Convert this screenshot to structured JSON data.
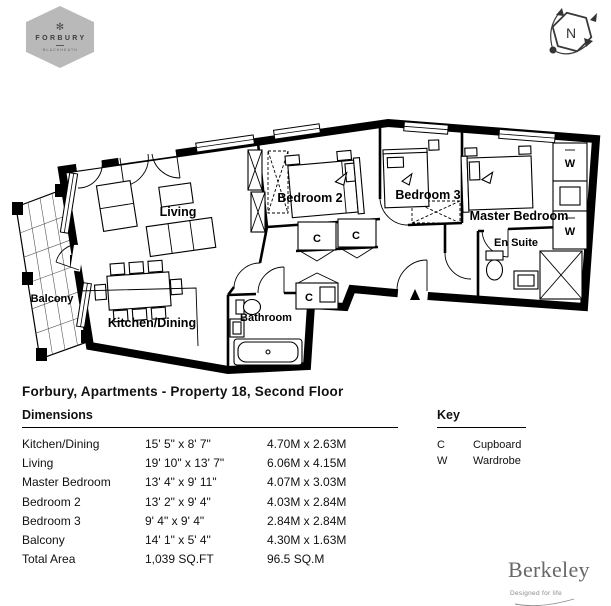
{
  "logo": {
    "name": "FORBURY",
    "tagline": "BLACKHEATH",
    "mark": "✻",
    "hex_color": "#b9b9b9"
  },
  "compass": {
    "north_label": "N"
  },
  "plan": {
    "room_labels": {
      "living": "Living",
      "kitchen_dining": "Kitchen/Dining",
      "balcony": "Balcony",
      "bathroom": "Bathroom",
      "bedroom2": "Bedroom 2",
      "bedroom3": "Bedroom 3",
      "master_bedroom": "Master Bedroom",
      "en_suite": "En Suite"
    },
    "symbols": {
      "cupboard": "C",
      "wardrobe": "W"
    }
  },
  "title": "Forbury, Apartments - Property 18, Second Floor",
  "dimensions": {
    "heading": "Dimensions",
    "rows": [
      {
        "room": "Kitchen/Dining",
        "imperial": "15' 5\" x 8' 7\"",
        "metric": "4.70M x 2.63M"
      },
      {
        "room": "Living",
        "imperial": "19' 10\" x 13' 7\"",
        "metric": "6.06M x 4.15M"
      },
      {
        "room": "Master Bedroom",
        "imperial": "13' 4\" x 9' 11\"",
        "metric": "4.07M x 3.03M"
      },
      {
        "room": "Bedroom 2",
        "imperial": "13' 2\" x 9' 4\"",
        "metric": "4.03M x 2.84M"
      },
      {
        "room": "Bedroom 3",
        "imperial": "9' 4\" x 9' 4\"",
        "metric": "2.84M x 2.84M"
      },
      {
        "room": "Balcony",
        "imperial": "14' 1\" x 5' 4\"",
        "metric": "4.30M x 1.63M"
      },
      {
        "room": "Total Area",
        "imperial": "1,039 SQ.FT",
        "metric": "96.5 SQ.M"
      }
    ]
  },
  "key": {
    "heading": "Key",
    "entries": [
      {
        "symbol": "C",
        "label": "Cupboard"
      },
      {
        "symbol": "W",
        "label": "Wardrobe"
      }
    ]
  },
  "brand": {
    "name": "Berkeley",
    "tagline": "Designed for life"
  }
}
